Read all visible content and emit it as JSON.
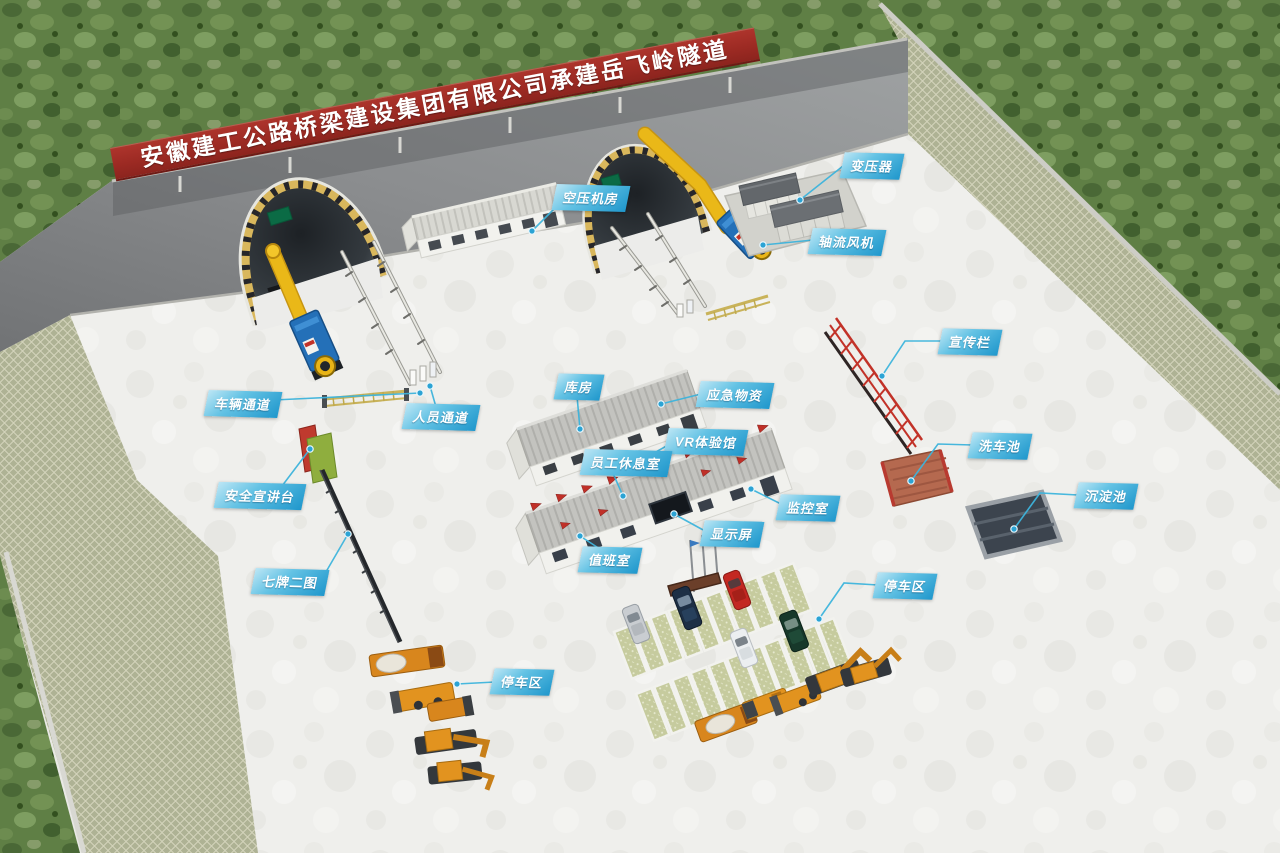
{
  "banner": {
    "text": "安徽建工公路桥梁建设集团有限公司承建岳飞岭隧道"
  },
  "labels": [
    {
      "text": "空压机房"
    },
    {
      "text": "变压器"
    },
    {
      "text": "轴流风机"
    },
    {
      "text": "车辆通道"
    },
    {
      "text": "人员通道"
    },
    {
      "text": "库房"
    },
    {
      "text": "应急物资"
    },
    {
      "text": "VR体验馆"
    },
    {
      "text": "员工休息室"
    },
    {
      "text": "监控室"
    },
    {
      "text": "显示屏"
    },
    {
      "text": "值班室"
    },
    {
      "text": "宣传栏"
    },
    {
      "text": "洗车池"
    },
    {
      "text": "沉淀池"
    },
    {
      "text": "停车区"
    },
    {
      "text": "停车区"
    },
    {
      "text": "安全宣讲台"
    },
    {
      "text": "七牌二图"
    }
  ],
  "colors": {
    "label_blue_light": "#bce6f5",
    "label_blue_dark": "#1f97cc",
    "banner_red": "#9c2a23",
    "duct_yellow": "#eab818",
    "fan_blue": "#2470b8",
    "tunnel_rim_yellow": "#d9b75c",
    "machine_orange": "#e0921f",
    "yard_concrete": "#efefec",
    "slope_lattice": "#aeb294",
    "vegetation_green": "#5f7f45"
  }
}
